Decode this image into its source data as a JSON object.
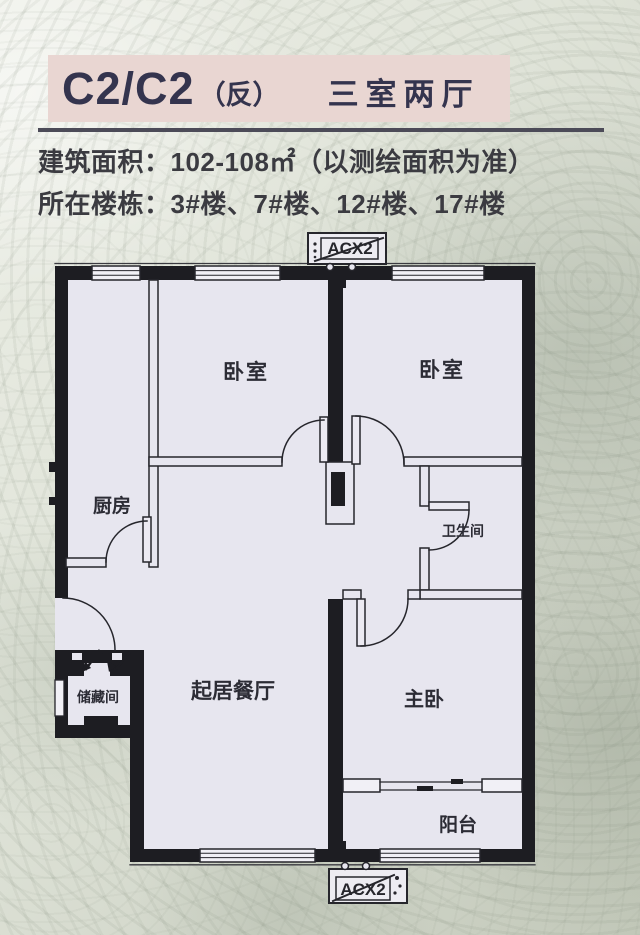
{
  "header": {
    "unit_code": "C2/C2",
    "variant": "（反）",
    "layout_type": "三室两厅"
  },
  "info": {
    "area_line": "建筑面积：102-108㎡（以测绘面积为准）",
    "building_line": "所在楼栋：3#楼、7#楼、12#楼、17#楼"
  },
  "floorplan": {
    "ac_top_label": "ACX2",
    "ac_bottom_label": "ACX2",
    "rooms": {
      "kitchen": "厨房",
      "bedroom_left": "卧室",
      "bedroom_right": "卧室",
      "bathroom": "卫生间",
      "storage": "储藏间",
      "living_dining": "起居餐厅",
      "master_bedroom": "主卧",
      "balcony": "阳台"
    }
  },
  "colors": {
    "banner_bg": "#e9d6d2",
    "banner_text": "#34344e",
    "rule": "#4c4b58",
    "info_text": "#3b3b41",
    "wall": "#1d1d22",
    "paper": "#e7e6ef"
  }
}
